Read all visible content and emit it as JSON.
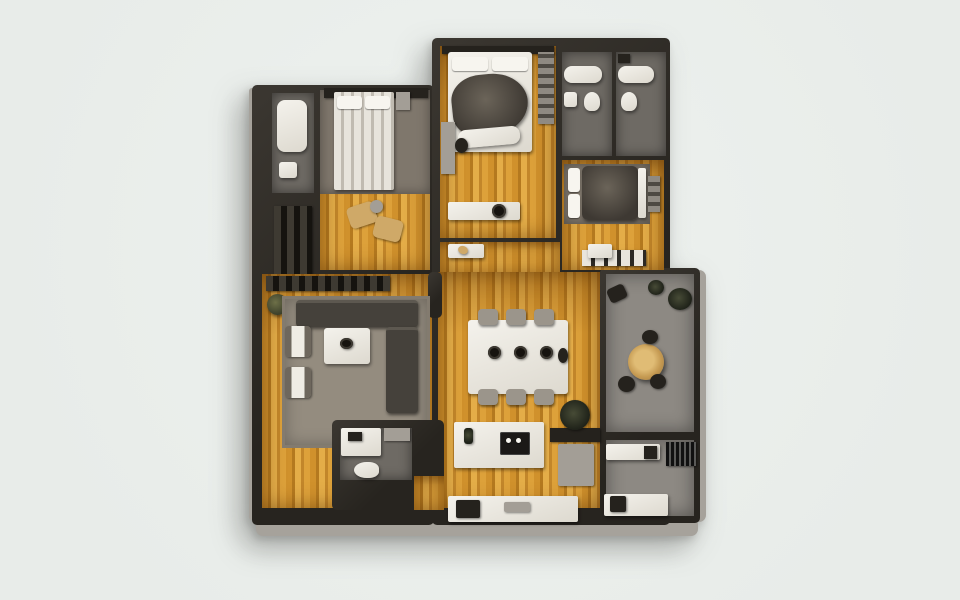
{
  "scene": {
    "kind": "apartment-floor-plan-3d-top-down-render",
    "rooms": [
      "bathroom-left",
      "closet-left",
      "bedroom-left",
      "master-bedroom",
      "bathroom-top-right-1",
      "bathroom-top-right-2",
      "bedroom-right",
      "hallway",
      "living-room",
      "dining-area",
      "balcony",
      "kitchen",
      "bathroom-bottom-left",
      "utility-room"
    ]
  },
  "palette": {
    "background": "#eef2ef",
    "wall": "#27241f",
    "wall_light": "#3b3731",
    "bevel": "#a6a29b",
    "wood_base": "#d0912c",
    "wood_dark": "#b4791f",
    "wood_light": "#e4ad48",
    "carpet": "#7f776c",
    "rug": "#948c7f",
    "bath_floor": "#6e6a64",
    "balcony_floor": "#8d8983",
    "fixture_white": "#edebe4",
    "sofa": "#45413b",
    "panel_dark": "#25221d",
    "panel_gray": "#a39e96",
    "accent_tan": "#cfa968",
    "plant_green": "#3c412f"
  },
  "plan": {
    "shapes": [
      {
        "n": "outer-edge-bottom",
        "x": 4,
        "y": 488,
        "w": 442,
        "h": 18,
        "c": "bevel"
      },
      {
        "n": "outer-edge-right",
        "x": 440,
        "y": 240,
        "w": 14,
        "h": 252,
        "c": "bevel"
      },
      {
        "n": "outer-edge-left",
        "x": -3,
        "y": 58,
        "w": 6,
        "h": 432,
        "c": "bevel"
      },
      {
        "n": "walls-left-wing",
        "x": 0,
        "y": 55,
        "w": 182,
        "h": 440,
        "c": "wall"
      },
      {
        "n": "walls-center-wing",
        "x": 180,
        "y": 8,
        "w": 238,
        "h": 487,
        "c": "wall"
      },
      {
        "n": "walls-right-wing",
        "x": 348,
        "y": 238,
        "w": 100,
        "h": 255,
        "c": "wall"
      },
      {
        "n": "bathroom-left-floor",
        "x": 20,
        "y": 63,
        "w": 42,
        "h": 100,
        "c": "bath"
      },
      {
        "n": "closet-left-shelves",
        "x": 22,
        "y": 176,
        "w": 38,
        "h": 88,
        "c": "shelves"
      },
      {
        "n": "bedroom-left-floor",
        "x": 68,
        "y": 60,
        "w": 110,
        "h": 180,
        "c": "wood"
      },
      {
        "n": "bedroom-left-carpet",
        "x": 68,
        "y": 60,
        "w": 110,
        "h": 104,
        "c": "carpet"
      },
      {
        "n": "master-bedroom-floor",
        "x": 188,
        "y": 16,
        "w": 116,
        "h": 192,
        "c": "wood"
      },
      {
        "n": "bathroom-tr1-floor",
        "x": 310,
        "y": 22,
        "w": 50,
        "h": 104,
        "c": "bath"
      },
      {
        "n": "bathroom-tr2-floor",
        "x": 364,
        "y": 22,
        "w": 50,
        "h": 104,
        "c": "bath"
      },
      {
        "n": "bedroom-right-floor",
        "x": 310,
        "y": 130,
        "w": 102,
        "h": 110,
        "c": "wood"
      },
      {
        "n": "hallway-floor",
        "x": 188,
        "y": 212,
        "w": 120,
        "h": 32,
        "c": "wood"
      },
      {
        "n": "living-room-floor",
        "x": 10,
        "y": 244,
        "w": 170,
        "h": 234,
        "c": "wood"
      },
      {
        "n": "dining-kitchen-floor",
        "x": 186,
        "y": 242,
        "w": 162,
        "h": 236,
        "c": "wood"
      },
      {
        "n": "balcony-floor",
        "x": 354,
        "y": 244,
        "w": 88,
        "h": 158,
        "c": "balc"
      },
      {
        "n": "utility-floor",
        "x": 354,
        "y": 410,
        "w": 88,
        "h": 76,
        "c": "balc"
      },
      {
        "n": "wall-column-living",
        "x": 176,
        "y": 242,
        "w": 14,
        "h": 46,
        "c": "wall"
      },
      {
        "n": "bathtub-left",
        "x": 25,
        "y": 70,
        "w": 30,
        "h": 52,
        "c": "fixture",
        "r": 8
      },
      {
        "n": "sink-left",
        "x": 27,
        "y": 132,
        "w": 18,
        "h": 16,
        "c": "fixture",
        "r": 3
      },
      {
        "n": "bedroom-left-headwall",
        "x": 72,
        "y": 58,
        "w": 104,
        "h": 10,
        "c": "dark"
      },
      {
        "n": "bedroom-left-bed",
        "x": 82,
        "y": 62,
        "w": 60,
        "h": 98,
        "c": "bedstripe"
      },
      {
        "n": "bedroom-left-pillow-1",
        "x": 85,
        "y": 66,
        "w": 25,
        "h": 13,
        "c": "pillow"
      },
      {
        "n": "bedroom-left-pillow-2",
        "x": 113,
        "y": 66,
        "w": 25,
        "h": 13,
        "c": "pillow"
      },
      {
        "n": "bedroom-left-nightstand",
        "x": 144,
        "y": 62,
        "w": 14,
        "h": 18,
        "c": "gray"
      },
      {
        "n": "lounge-chair-1",
        "x": 96,
        "y": 174,
        "w": 28,
        "h": 22,
        "c": "tan",
        "r": 5,
        "t": -18
      },
      {
        "n": "lounge-chair-2",
        "x": 122,
        "y": 188,
        "w": 28,
        "h": 22,
        "c": "tan",
        "r": 5,
        "t": 14
      },
      {
        "n": "lounge-side-table",
        "x": 118,
        "y": 170,
        "w": 13,
        "h": 13,
        "c": "gray",
        "r": "50%"
      },
      {
        "n": "master-headwall",
        "x": 190,
        "y": 16,
        "w": 112,
        "h": 8,
        "c": "dark"
      },
      {
        "n": "master-bed",
        "x": 196,
        "y": 22,
        "w": 84,
        "h": 100,
        "c": "fixture",
        "r": 3
      },
      {
        "n": "master-pillow-1",
        "x": 200,
        "y": 27,
        "w": 36,
        "h": 14,
        "c": "pillow"
      },
      {
        "n": "master-pillow-2",
        "x": 240,
        "y": 27,
        "w": 36,
        "h": 14,
        "c": "pillow"
      },
      {
        "n": "master-blanket",
        "x": 200,
        "y": 44,
        "w": 76,
        "h": 62,
        "c": "blanket",
        "r": "45% 55% 60% 42%",
        "t": -6
      },
      {
        "n": "master-sheet-fold",
        "x": 206,
        "y": 98,
        "w": 62,
        "h": 18,
        "c": "fixture",
        "r": 8,
        "t": -5
      },
      {
        "n": "master-desk",
        "x": 189,
        "y": 92,
        "w": 14,
        "h": 52,
        "c": "gray"
      },
      {
        "n": "master-desk-chair",
        "x": 203,
        "y": 108,
        "w": 13,
        "h": 15,
        "c": "dark",
        "r": "50%"
      },
      {
        "n": "master-closet",
        "x": 286,
        "y": 22,
        "w": 16,
        "h": 72,
        "c": "shelvesv"
      },
      {
        "n": "master-dresser",
        "x": 196,
        "y": 172,
        "w": 72,
        "h": 18,
        "c": "fixture"
      },
      {
        "n": "master-basin",
        "x": 240,
        "y": 174,
        "w": 14,
        "h": 14,
        "c": "darkcircle"
      },
      {
        "n": "bathtub-tr1",
        "x": 312,
        "y": 36,
        "w": 38,
        "h": 17,
        "c": "fixture",
        "r": 8
      },
      {
        "n": "sink-tr1",
        "x": 312,
        "y": 62,
        "w": 13,
        "h": 15,
        "c": "fixture",
        "r": 3
      },
      {
        "n": "toilet-tr1",
        "x": 332,
        "y": 62,
        "w": 16,
        "h": 19,
        "c": "fixture",
        "r": "50% 50% 40% 40%"
      },
      {
        "n": "bathtub-tr2",
        "x": 366,
        "y": 36,
        "w": 36,
        "h": 17,
        "c": "fixture",
        "r": 8
      },
      {
        "n": "toilet-tr2",
        "x": 369,
        "y": 62,
        "w": 16,
        "h": 19,
        "c": "fixture",
        "r": "50% 50% 40% 40%"
      },
      {
        "n": "cabinet-tr2",
        "x": 366,
        "y": 24,
        "w": 12,
        "h": 9,
        "c": "dark"
      },
      {
        "n": "bedroom-right-carpet",
        "x": 312,
        "y": 134,
        "w": 86,
        "h": 60,
        "c": "carpet"
      },
      {
        "n": "bedroom-right-pillow-1",
        "x": 316,
        "y": 138,
        "w": 12,
        "h": 24,
        "c": "pillow"
      },
      {
        "n": "bedroom-right-pillow-2",
        "x": 316,
        "y": 164,
        "w": 12,
        "h": 24,
        "c": "pillow"
      },
      {
        "n": "bedroom-right-duvet",
        "x": 330,
        "y": 136,
        "w": 56,
        "h": 54,
        "c": "blanket",
        "r": 6
      },
      {
        "n": "bedroom-right-sheet",
        "x": 386,
        "y": 138,
        "w": 8,
        "h": 50,
        "c": "fixture",
        "r": 2
      },
      {
        "n": "bedroom-right-nightstand",
        "x": 396,
        "y": 146,
        "w": 12,
        "h": 36,
        "c": "shelvesv"
      },
      {
        "n": "bedroom-right-wardrobe",
        "x": 330,
        "y": 220,
        "w": 64,
        "h": 16,
        "c": "wardrobe"
      },
      {
        "n": "hall-console",
        "x": 196,
        "y": 214,
        "w": 36,
        "h": 14,
        "c": "fixture"
      },
      {
        "n": "hall-console-item",
        "x": 206,
        "y": 216,
        "w": 10,
        "h": 8,
        "c": "tan",
        "r": "50%",
        "t": 20
      },
      {
        "n": "hall-cabinet",
        "x": 336,
        "y": 214,
        "w": 24,
        "h": 14,
        "c": "fixture"
      },
      {
        "n": "living-wall-shelf",
        "x": 14,
        "y": 246,
        "w": 124,
        "h": 15,
        "c": "shelves"
      },
      {
        "n": "living-plant",
        "x": 15,
        "y": 264,
        "w": 21,
        "h": 21,
        "c": "plant"
      },
      {
        "n": "living-rug",
        "x": 30,
        "y": 266,
        "w": 148,
        "h": 152,
        "c": "rug"
      },
      {
        "n": "sofa-top",
        "x": 44,
        "y": 270,
        "w": 122,
        "h": 27,
        "c": "sofa"
      },
      {
        "n": "sofa-right",
        "x": 134,
        "y": 297,
        "w": 32,
        "h": 86,
        "c": "sofa"
      },
      {
        "n": "coffee-table",
        "x": 72,
        "y": 298,
        "w": 46,
        "h": 36,
        "c": "fixture",
        "r": 3
      },
      {
        "n": "coffee-table-decor",
        "x": 88,
        "y": 308,
        "w": 13,
        "h": 11,
        "c": "darkcircle"
      },
      {
        "n": "armchair-1",
        "x": 33,
        "y": 296,
        "w": 26,
        "h": 31,
        "c": "armchair"
      },
      {
        "n": "armchair-2",
        "x": 33,
        "y": 337,
        "w": 26,
        "h": 31,
        "c": "armchair"
      },
      {
        "n": "dining-table",
        "x": 216,
        "y": 290,
        "w": 100,
        "h": 74,
        "c": "fixture",
        "r": 3
      },
      {
        "n": "dining-chair-t1",
        "x": 226,
        "y": 279,
        "w": 20,
        "h": 16,
        "c": "chair"
      },
      {
        "n": "dining-chair-t2",
        "x": 254,
        "y": 279,
        "w": 20,
        "h": 16,
        "c": "chair"
      },
      {
        "n": "dining-chair-t3",
        "x": 282,
        "y": 279,
        "w": 20,
        "h": 16,
        "c": "chair"
      },
      {
        "n": "dining-chair-b1",
        "x": 226,
        "y": 359,
        "w": 20,
        "h": 16,
        "c": "chair"
      },
      {
        "n": "dining-chair-b2",
        "x": 254,
        "y": 359,
        "w": 20,
        "h": 16,
        "c": "chair"
      },
      {
        "n": "dining-chair-b3",
        "x": 282,
        "y": 359,
        "w": 20,
        "h": 16,
        "c": "chair"
      },
      {
        "n": "dining-plate-1",
        "x": 236,
        "y": 316,
        "w": 13,
        "h": 13,
        "c": "darkcircle"
      },
      {
        "n": "dining-plate-2",
        "x": 262,
        "y": 316,
        "w": 13,
        "h": 13,
        "c": "darkcircle"
      },
      {
        "n": "dining-plate-3",
        "x": 288,
        "y": 316,
        "w": 13,
        "h": 13,
        "c": "darkcircle"
      },
      {
        "n": "dining-vase",
        "x": 306,
        "y": 318,
        "w": 10,
        "h": 15,
        "c": "dark",
        "r": "50%"
      },
      {
        "n": "balcony-plant-1",
        "x": 416,
        "y": 258,
        "w": 24,
        "h": 22,
        "c": "plantdark"
      },
      {
        "n": "balcony-plant-2",
        "x": 396,
        "y": 250,
        "w": 16,
        "h": 15,
        "c": "plantdark"
      },
      {
        "n": "balcony-lounge",
        "x": 356,
        "y": 256,
        "w": 18,
        "h": 15,
        "c": "dark",
        "r": 4,
        "t": -25
      },
      {
        "n": "balcony-table",
        "x": 376,
        "y": 314,
        "w": 36,
        "h": 36,
        "c": "tantable"
      },
      {
        "n": "balcony-chair-1",
        "x": 366,
        "y": 346,
        "w": 17,
        "h": 16,
        "c": "dark",
        "r": "50%"
      },
      {
        "n": "balcony-chair-2",
        "x": 398,
        "y": 344,
        "w": 16,
        "h": 15,
        "c": "dark",
        "r": "50%"
      },
      {
        "n": "balcony-chair-3",
        "x": 390,
        "y": 300,
        "w": 16,
        "h": 14,
        "c": "dark",
        "r": "50%"
      },
      {
        "n": "kitchen-dark-counter",
        "x": 298,
        "y": 398,
        "w": 50,
        "h": 14,
        "c": "dark"
      },
      {
        "n": "kitchen-fridge",
        "x": 306,
        "y": 414,
        "w": 36,
        "h": 42,
        "c": "gray",
        "r": 2
      },
      {
        "n": "kitchen-plant",
        "x": 308,
        "y": 370,
        "w": 30,
        "h": 30,
        "c": "plantdark"
      },
      {
        "n": "kitchen-island",
        "x": 202,
        "y": 392,
        "w": 90,
        "h": 46,
        "c": "fixture",
        "r": 2
      },
      {
        "n": "kitchen-cooktop",
        "x": 248,
        "y": 402,
        "w": 30,
        "h": 23,
        "c": "cooktop"
      },
      {
        "n": "cooktop-knob-1",
        "x": 254,
        "y": 408,
        "w": 5,
        "h": 5,
        "c": "pillow",
        "r": "50%"
      },
      {
        "n": "cooktop-knob-2",
        "x": 264,
        "y": 408,
        "w": 5,
        "h": 5,
        "c": "pillow",
        "r": "50%"
      },
      {
        "n": "island-bottle",
        "x": 212,
        "y": 398,
        "w": 9,
        "h": 16,
        "c": "plantdark",
        "r": 3
      },
      {
        "n": "kitchen-counter",
        "x": 196,
        "y": 466,
        "w": 130,
        "h": 26,
        "c": "fixture"
      },
      {
        "n": "kitchen-sink",
        "x": 204,
        "y": 470,
        "w": 24,
        "h": 18,
        "c": "dark",
        "r": 2
      },
      {
        "n": "kitchen-counter-items",
        "x": 252,
        "y": 472,
        "w": 26,
        "h": 10,
        "c": "gray",
        "r": 2
      },
      {
        "n": "bathroom-bl-walls",
        "x": 80,
        "y": 390,
        "w": 112,
        "h": 90,
        "c": "wall"
      },
      {
        "n": "bathroom-bl-floor",
        "x": 88,
        "y": 398,
        "w": 72,
        "h": 52,
        "c": "bath"
      },
      {
        "n": "bathroom-bl-shower",
        "x": 89,
        "y": 398,
        "w": 40,
        "h": 28,
        "c": "fixture"
      },
      {
        "n": "bathroom-bl-shower-item",
        "x": 96,
        "y": 402,
        "w": 14,
        "h": 9,
        "c": "dark"
      },
      {
        "n": "bathroom-bl-counter",
        "x": 132,
        "y": 398,
        "w": 26,
        "h": 13,
        "c": "gray"
      },
      {
        "n": "bathroom-bl-toilet",
        "x": 102,
        "y": 432,
        "w": 25,
        "h": 16,
        "c": "fixture",
        "r": "50% 40% 40% 50%"
      },
      {
        "n": "bathroom-bl-doorway",
        "x": 162,
        "y": 446,
        "w": 30,
        "h": 34,
        "c": "wood"
      },
      {
        "n": "utility-counter-top",
        "x": 354,
        "y": 414,
        "w": 54,
        "h": 16,
        "c": "fixture"
      },
      {
        "n": "utility-door",
        "x": 392,
        "y": 416,
        "w": 13,
        "h": 13,
        "c": "dark"
      },
      {
        "n": "utility-vent",
        "x": 414,
        "y": 412,
        "w": 30,
        "h": 24,
        "c": "vent"
      },
      {
        "n": "utility-counter-bottom",
        "x": 352,
        "y": 464,
        "w": 64,
        "h": 22,
        "c": "fixture"
      },
      {
        "n": "utility-oven",
        "x": 358,
        "y": 466,
        "w": 16,
        "h": 16,
        "c": "dark",
        "r": 2
      }
    ]
  }
}
